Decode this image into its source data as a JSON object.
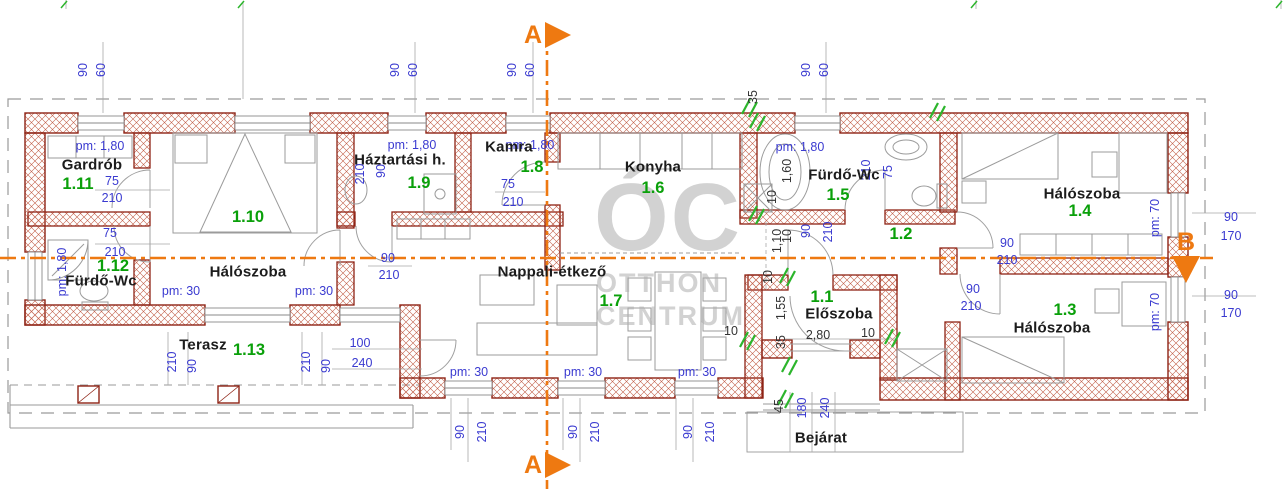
{
  "colors": {
    "wall": "#8e2315",
    "hatch": "#c2604a",
    "dim": "#3a3ad0",
    "number": "#0aa00a",
    "label": "#1c1c1c",
    "section": "#ee7911",
    "break": "#2cb52c",
    "gray": "#9a9a9a",
    "watermark": "#aeaeae"
  },
  "watermark": {
    "big": "ÓC",
    "line2": "OTTHON",
    "line3": "CENTRUM"
  },
  "sections": {
    "a": {
      "label": "A"
    },
    "b": {
      "label": "B"
    }
  },
  "entrance": {
    "label": "Bejárat",
    "x": 821,
    "y": 438
  },
  "rooms": [
    {
      "name": "gardrob",
      "label": "Gardrób",
      "number": "1.11",
      "lx": 92,
      "ly": 165,
      "nx": 78,
      "ny": 184
    },
    {
      "name": "halo-1-10",
      "label": "Hálószoba",
      "number": "1.10",
      "lx": 248,
      "ly": 272,
      "nx": 248,
      "ny": 217
    },
    {
      "name": "furdo-1-12",
      "label": "Fürdő-Wc",
      "number": "1.12",
      "lx": 101,
      "ly": 281,
      "nx": 113,
      "ny": 266
    },
    {
      "name": "terasz",
      "label": "Terasz",
      "number": "1.13",
      "lx": 203,
      "ly": 345,
      "nx": 249,
      "ny": 350
    },
    {
      "name": "haztartasi",
      "label": "Háztartási h.",
      "number": "1.9",
      "lx": 400,
      "ly": 160,
      "nx": 419,
      "ny": 183
    },
    {
      "name": "kamra",
      "label": "Kamra",
      "number": "1.8",
      "lx": 509,
      "ly": 147,
      "nx": 532,
      "ny": 167
    },
    {
      "name": "konyha",
      "label": "Konyha",
      "number": "1.6",
      "lx": 653,
      "ly": 167,
      "nx": 653,
      "ny": 188
    },
    {
      "name": "nappali",
      "label": "Nappali-étkező",
      "number": "1.7",
      "lx": 552,
      "ly": 272,
      "nx": 611,
      "ny": 301
    },
    {
      "name": "furdo-1-5",
      "label": "Fürdő-Wc",
      "number": "1.5",
      "lx": 844,
      "ly": 175,
      "nx": 838,
      "ny": 195
    },
    {
      "name": "kozlekedo-1-2",
      "label": "",
      "number": "1.2",
      "nx": 901,
      "ny": 234
    },
    {
      "name": "eloszoba",
      "label": "Előszoba",
      "number": "1.1",
      "lx": 839,
      "ly": 314,
      "nx": 822,
      "ny": 297
    },
    {
      "name": "halo-1-4",
      "label": "Hálószoba",
      "number": "1.4",
      "lx": 1082,
      "ly": 194,
      "nx": 1080,
      "ny": 211
    },
    {
      "name": "halo-1-3",
      "label": "Hálószoba",
      "number": "1.3",
      "lx": 1052,
      "ly": 328,
      "nx": 1065,
      "ny": 310
    }
  ],
  "dims": [
    {
      "t": "90",
      "x": 83,
      "y": 70,
      "r": -90
    },
    {
      "t": "60",
      "x": 101,
      "y": 70,
      "r": -90
    },
    {
      "t": "90",
      "x": 395,
      "y": 70,
      "r": -90
    },
    {
      "t": "60",
      "x": 413,
      "y": 70,
      "r": -90
    },
    {
      "t": "90",
      "x": 512,
      "y": 70,
      "r": -90
    },
    {
      "t": "60",
      "x": 530,
      "y": 70,
      "r": -90
    },
    {
      "t": "90",
      "x": 806,
      "y": 70,
      "r": -90
    },
    {
      "t": "60",
      "x": 824,
      "y": 70,
      "r": -90
    },
    {
      "t": "35",
      "x": 753,
      "y": 97,
      "r": -90,
      "c": "k"
    },
    {
      "t": "pm: 1,80",
      "x": 100,
      "y": 146
    },
    {
      "t": "75",
      "x": 112,
      "y": 181
    },
    {
      "t": "210",
      "x": 112,
      "y": 198
    },
    {
      "t": "pm: 1,80",
      "x": 62,
      "y": 272,
      "r": -90
    },
    {
      "t": "75",
      "x": 110,
      "y": 233
    },
    {
      "t": "210",
      "x": 115,
      "y": 252
    },
    {
      "t": "pm: 30",
      "x": 181,
      "y": 291
    },
    {
      "t": "pm: 30",
      "x": 314,
      "y": 291
    },
    {
      "t": "pm: 1,80",
      "x": 412,
      "y": 145
    },
    {
      "t": "210",
      "x": 360,
      "y": 174,
      "r": -90
    },
    {
      "t": "90",
      "x": 381,
      "y": 171,
      "r": -90
    },
    {
      "t": "90",
      "x": 388,
      "y": 258
    },
    {
      "t": "210",
      "x": 389,
      "y": 275
    },
    {
      "t": "pm: 1,80",
      "x": 530,
      "y": 145
    },
    {
      "t": "75",
      "x": 508,
      "y": 184
    },
    {
      "t": "210",
      "x": 513,
      "y": 202
    },
    {
      "t": "pm: 1,80",
      "x": 800,
      "y": 147
    },
    {
      "t": "1,60",
      "x": 787,
      "y": 171,
      "r": -90,
      "c": "k"
    },
    {
      "t": "10",
      "x": 787,
      "y": 236,
      "r": -90,
      "c": "k"
    },
    {
      "t": "210",
      "x": 866,
      "y": 170,
      "r": -90
    },
    {
      "t": "75",
      "x": 888,
      "y": 172,
      "r": -90
    },
    {
      "t": "10",
      "x": 772,
      "y": 197,
      "r": -90,
      "c": "k"
    },
    {
      "t": "1,10",
      "x": 777,
      "y": 241,
      "r": -90,
      "c": "k"
    },
    {
      "t": "90",
      "x": 806,
      "y": 231,
      "r": -90
    },
    {
      "t": "210",
      "x": 828,
      "y": 232,
      "r": -90
    },
    {
      "t": "10",
      "x": 768,
      "y": 277,
      "r": -90,
      "c": "k"
    },
    {
      "t": "1,55",
      "x": 781,
      "y": 308,
      "r": -90,
      "c": "k"
    },
    {
      "t": "35",
      "x": 781,
      "y": 342,
      "r": -90,
      "c": "k"
    },
    {
      "t": "10",
      "x": 731,
      "y": 331,
      "c": "k"
    },
    {
      "t": "2,80",
      "x": 818,
      "y": 335,
      "c": "k"
    },
    {
      "t": "10",
      "x": 868,
      "y": 333,
      "c": "k"
    },
    {
      "t": "45",
      "x": 779,
      "y": 406,
      "r": -90,
      "c": "k"
    },
    {
      "t": "180",
      "x": 802,
      "y": 408,
      "r": -90
    },
    {
      "t": "240",
      "x": 825,
      "y": 408,
      "r": -90
    },
    {
      "t": "90",
      "x": 1007,
      "y": 243
    },
    {
      "t": "210",
      "x": 1007,
      "y": 260
    },
    {
      "t": "pm: 70",
      "x": 1155,
      "y": 218,
      "r": -90
    },
    {
      "t": "90",
      "x": 1231,
      "y": 217
    },
    {
      "t": "170",
      "x": 1231,
      "y": 236
    },
    {
      "t": "90",
      "x": 973,
      "y": 289
    },
    {
      "t": "210",
      "x": 971,
      "y": 306
    },
    {
      "t": "pm: 70",
      "x": 1155,
      "y": 312,
      "r": -90
    },
    {
      "t": "90",
      "x": 1231,
      "y": 295
    },
    {
      "t": "170",
      "x": 1231,
      "y": 313
    },
    {
      "t": "pm: 30",
      "x": 469,
      "y": 372
    },
    {
      "t": "pm: 30",
      "x": 583,
      "y": 372
    },
    {
      "t": "pm: 30",
      "x": 697,
      "y": 372
    },
    {
      "t": "90",
      "x": 460,
      "y": 432,
      "r": -90
    },
    {
      "t": "210",
      "x": 482,
      "y": 432,
      "r": -90
    },
    {
      "t": "90",
      "x": 573,
      "y": 432,
      "r": -90
    },
    {
      "t": "210",
      "x": 595,
      "y": 432,
      "r": -90
    },
    {
      "t": "90",
      "x": 688,
      "y": 432,
      "r": -90
    },
    {
      "t": "210",
      "x": 710,
      "y": 432,
      "r": -90
    },
    {
      "t": "210",
      "x": 172,
      "y": 362,
      "r": -90
    },
    {
      "t": "90",
      "x": 192,
      "y": 366,
      "r": -90
    },
    {
      "t": "210",
      "x": 306,
      "y": 362,
      "r": -90
    },
    {
      "t": "90",
      "x": 326,
      "y": 366,
      "r": -90
    },
    {
      "t": "100",
      "x": 360,
      "y": 343
    },
    {
      "t": "240",
      "x": 362,
      "y": 363
    }
  ]
}
